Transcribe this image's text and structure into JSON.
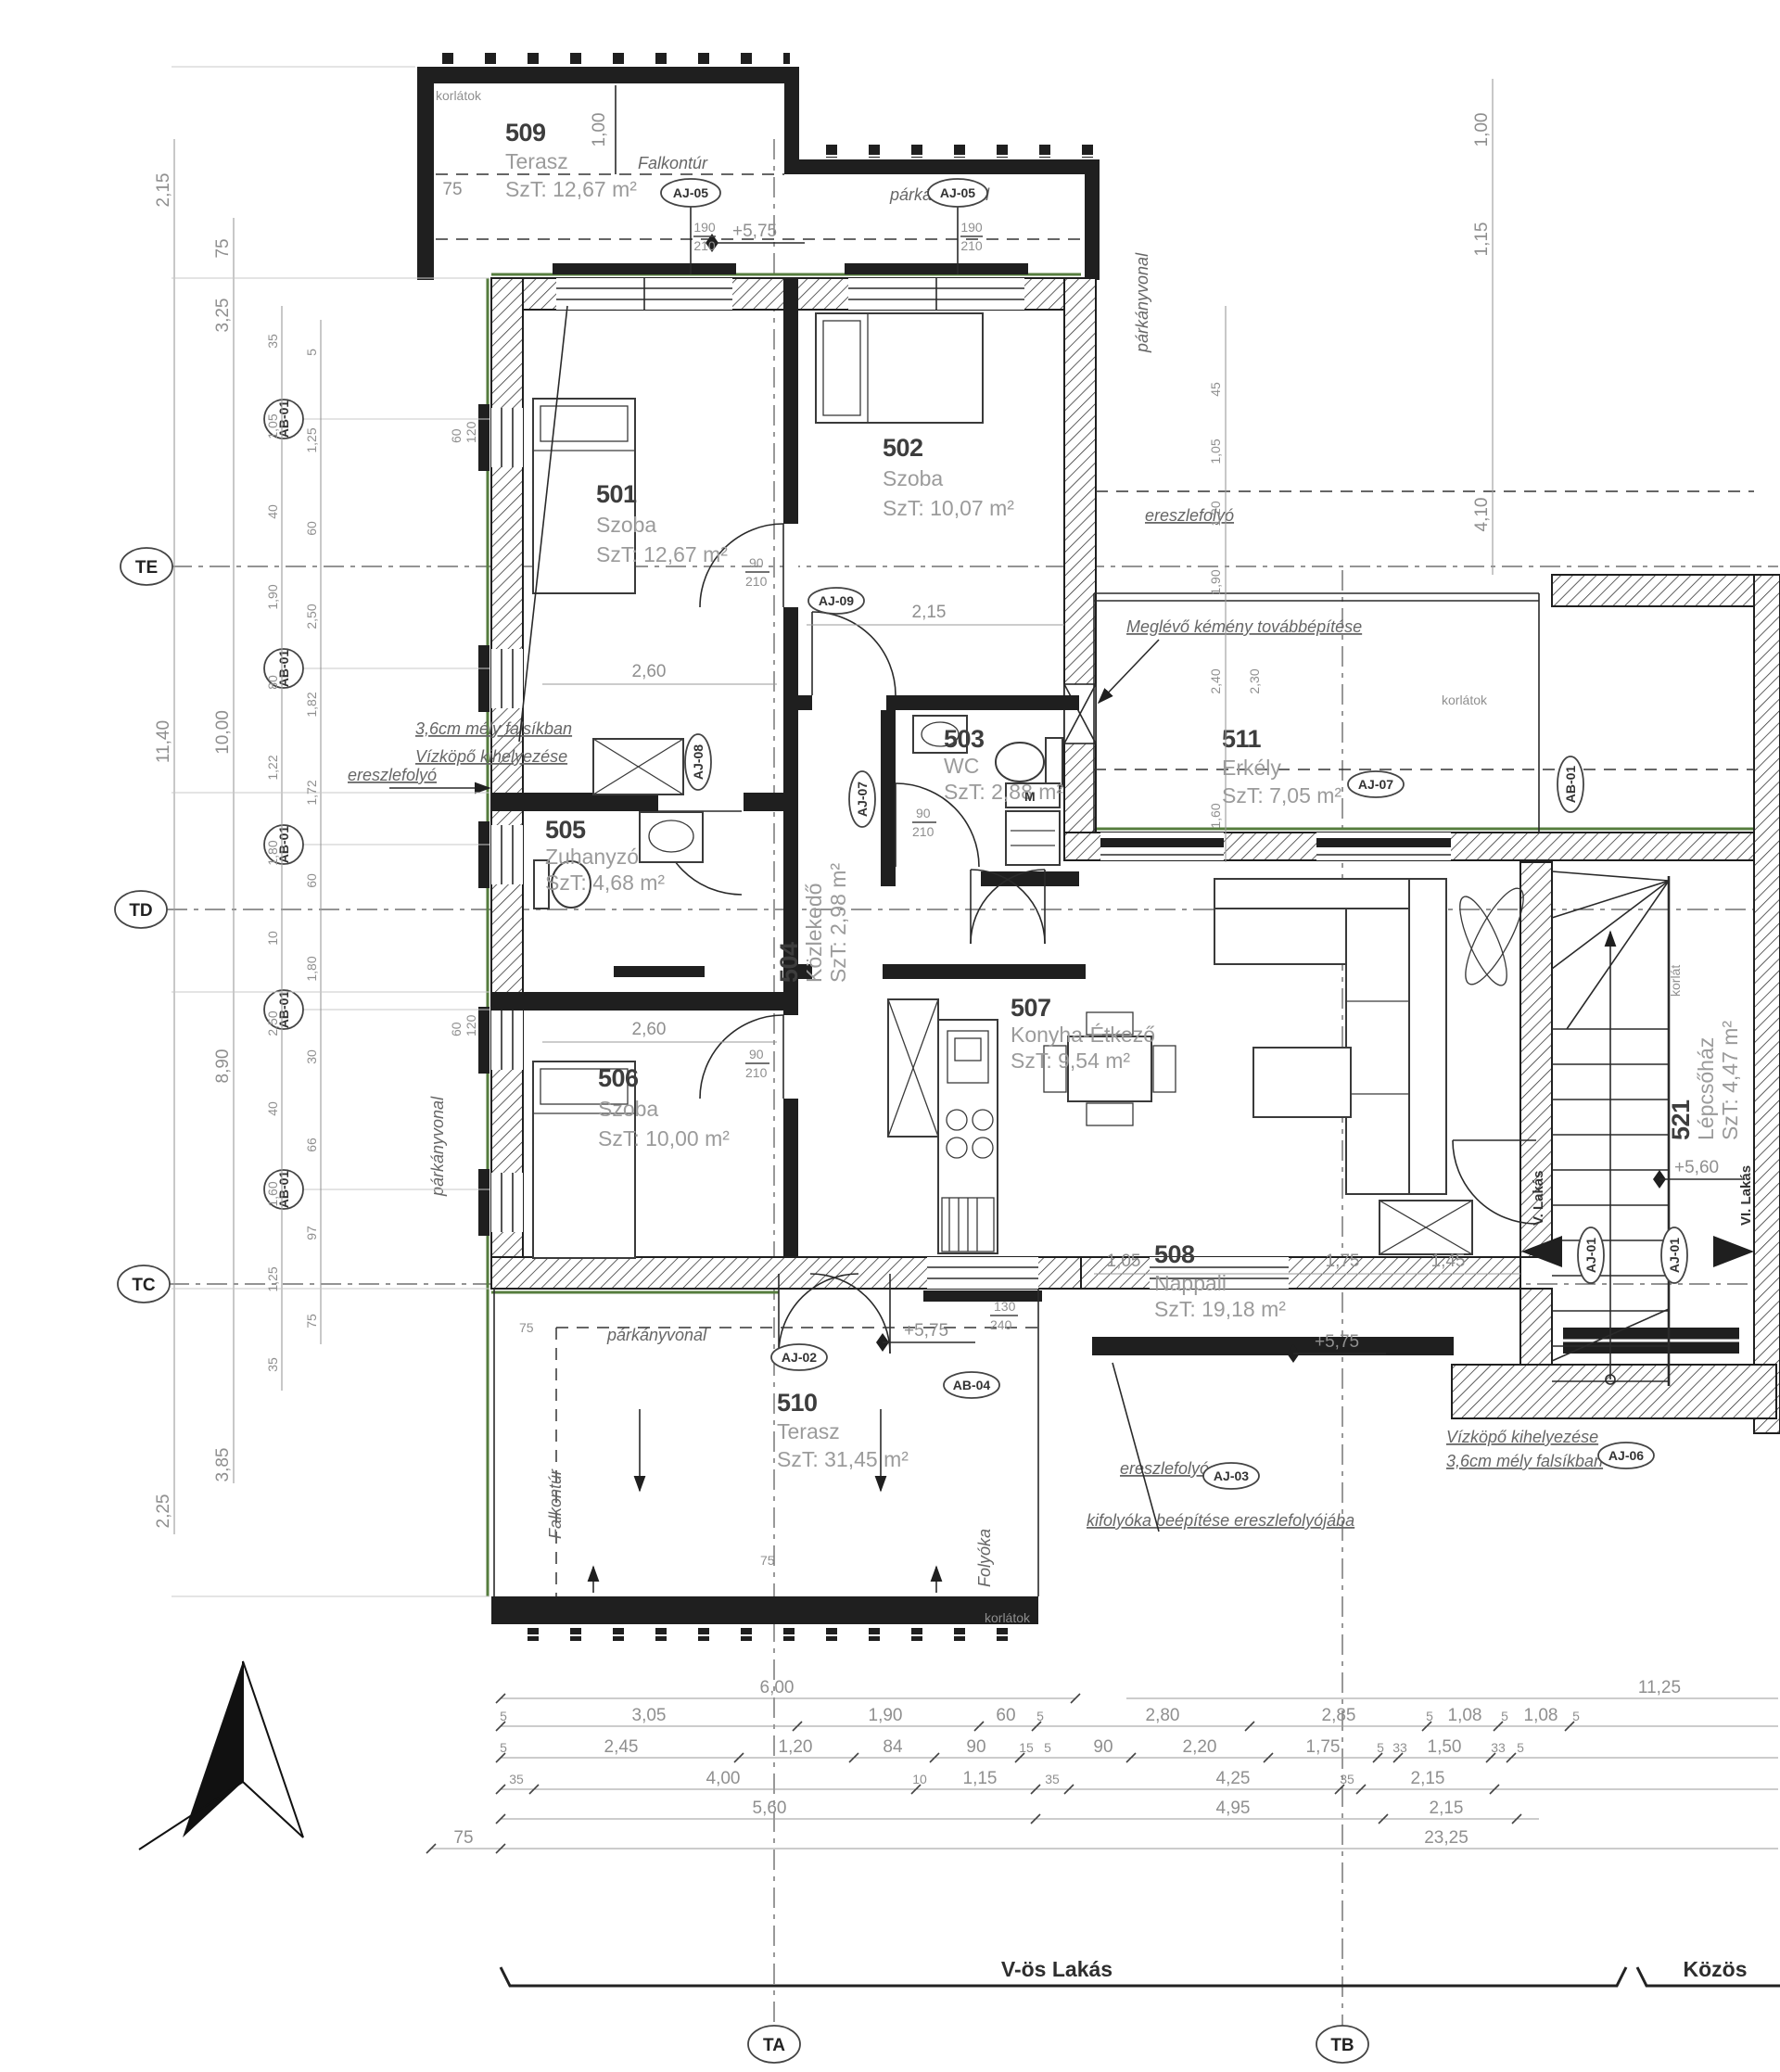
{
  "colors": {
    "wall": "#1f1f1f",
    "insulation": "#567d3e",
    "dim_text": "#8f8f8f",
    "room_number": "#3d3d3d",
    "room_text": "#9b9b9b",
    "annotation": "#666666"
  },
  "rooms": [
    {
      "num": "501",
      "name": "Szoba",
      "area": "SzT: 12,67 m²"
    },
    {
      "num": "502",
      "name": "Szoba",
      "area": "SzT: 10,07 m²"
    },
    {
      "num": "503",
      "name": "WC",
      "area": "SzT: 2,88 m²"
    },
    {
      "num": "504",
      "name": "Közlekedő",
      "area": "SzT: 2,98 m²"
    },
    {
      "num": "505",
      "name": "Zuhanyzó",
      "area": "SzT: 4,68 m²"
    },
    {
      "num": "506",
      "name": "Szoba",
      "area": "SzT: 10,00 m²"
    },
    {
      "num": "507",
      "name": "Konyha-Étkező",
      "area": "SzT: 9,54 m²"
    },
    {
      "num": "508",
      "name": "Nappali",
      "area": "SzT: 19,18 m²"
    },
    {
      "num": "509",
      "name": "Terasz",
      "area": "SzT: 12,67 m²"
    },
    {
      "num": "510",
      "name": "Terasz",
      "area": "SzT: 31,45 m²"
    },
    {
      "num": "511",
      "name": "Erkély",
      "area": "SzT: 7,05 m²"
    },
    {
      "num": "521",
      "name": "Lépcsőház",
      "area": "SzT: 4,47 m²"
    }
  ],
  "grid": {
    "te": "TE",
    "td": "TD",
    "tc": "TC",
    "ta": "TA",
    "tb": "TB"
  },
  "zones": {
    "left": "V-ös Lakás",
    "right": "Közös"
  },
  "annotations": {
    "korlatok": "korlátok",
    "korlat": "korlát",
    "falkontur": "Falkontúr",
    "parkanyvonal": "párkányvonal",
    "ereszlefolyo": "ereszlefolyó",
    "kemeny": "Meglévő kémény továbbépítése",
    "vizkopo1": "Vízköpő kihelyezése",
    "vizkopo2": "3,6cm mély falsíkban",
    "kifolyoka": "kifolyóka beépítése ereszlefolyójába",
    "folyoka": "Folyóka",
    "lakas5": "V. Lakás",
    "lakas6": "VI. Lakás",
    "mosogep": "M"
  },
  "elevations": {
    "e575": "+5,75",
    "e560": "+5,60"
  },
  "tags": {
    "aj01": "AJ-01",
    "aj02": "AJ-02",
    "aj03": "AJ-03",
    "aj05": "AJ-05",
    "aj06": "AJ-06",
    "aj07": "AJ-07",
    "aj08": "AJ-08",
    "aj09": "AJ-09",
    "ab01": "AB-01",
    "ab04": "AB-04"
  },
  "door_sizes": {
    "w90": "90",
    "h210": "210",
    "w190": "190",
    "w130": "130",
    "h240": "240",
    "w60": "60",
    "h120": "120"
  },
  "dims": {
    "bl1": [
      "6,00"
    ],
    "bl2": [
      "5",
      "3,05",
      "1,90",
      "60",
      "5"
    ],
    "bl3": [
      "5",
      "2,45",
      "1,20",
      "84",
      "90",
      "15",
      "5"
    ],
    "bl4": [
      "35",
      "4,00",
      "10",
      "1,15",
      "35"
    ],
    "bl5": [
      "5,60"
    ],
    "bl6": [
      "75"
    ],
    "br1": [
      "11,25"
    ],
    "br2": [
      "2,80",
      "2,85",
      "5",
      "1,08",
      "5",
      "1,08",
      "5"
    ],
    "br3": [
      "90",
      "2,20",
      "1,75",
      "5",
      "33",
      "1,50",
      "33",
      "5"
    ],
    "br4": [
      "4,25",
      "35",
      "2,15"
    ],
    "br5": [
      "4,95",
      "2,15"
    ],
    "br6": [
      "23,25"
    ],
    "lcol1": [
      "2,15",
      "11,40",
      "2,25"
    ],
    "lcol2": [
      "75",
      "3,25",
      "10,00",
      "8,90",
      "3,85"
    ],
    "lcol3": [
      "35",
      "1,05",
      "40",
      "1,90",
      "80",
      "1,22",
      "1,80",
      "10",
      "2,50",
      "40",
      "1,60",
      "1,25",
      "35"
    ],
    "lcol4": [
      "5",
      "1,25",
      "60",
      "2,50",
      "1,82",
      "1,72",
      "60",
      "1,80",
      "30",
      "66",
      "97",
      "75"
    ],
    "rcol1": [
      "45",
      "1,05",
      "1,20",
      "1,90",
      "2,40",
      "2,30",
      "1,60"
    ],
    "rcol2": [
      "1,00",
      "1,15",
      "4,10"
    ],
    "top": [
      "1,00"
    ],
    "inner": [
      "2,60",
      "2,15",
      "2,60",
      "1,05",
      "1,75",
      "1,45"
    ]
  }
}
